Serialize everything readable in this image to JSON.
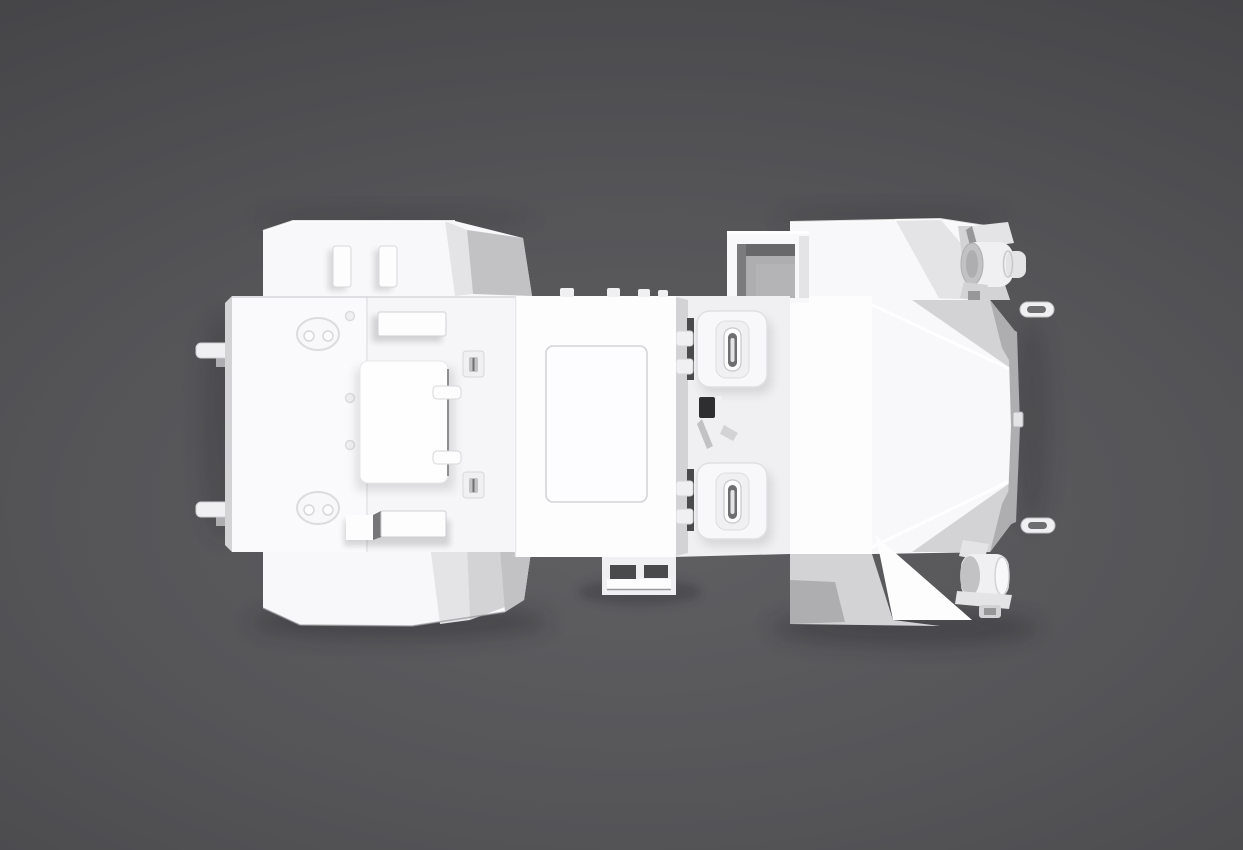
{
  "scene": {
    "type": "3d-render",
    "view": "top-down orthographic",
    "subject": "white armored scout vehicle model on dark gray studio backdrop"
  },
  "palette": {
    "bg_center": "#606063",
    "bg_mid1": "#555558",
    "bg_mid2": "#49494c",
    "bg_edge": "#3b3b3e",
    "c_bright": "#fdfdfe",
    "c_white": "#f8f8fa",
    "c_soft": "#f0f0f2",
    "c_light": "#e4e4e7",
    "c_mid": "#d3d3d6",
    "c_gray": "#c2c2c5",
    "c_dark": "#aeaeb1",
    "c_edge": "#97979a",
    "c_recess": "#6e6e71",
    "c_deep": "#4a4a4d",
    "c_black": "#2e2e30",
    "c_shadow": "#1f1f21"
  },
  "parts": [
    "top-left-fender",
    "fender-light-left",
    "fender-light-right",
    "bottom-left-fender",
    "front-plate",
    "plate-side-edge",
    "lifting-eye-upper",
    "lifting-eye-lower",
    "plate-bolts",
    "stowage-box-top",
    "windshield-hatch",
    "windshield-hinges",
    "latch-block-upper",
    "latch-block-lower",
    "stowage-box-bottom",
    "stowage-cube",
    "tow-hook-upper",
    "tow-hook-lower",
    "cabin-roof",
    "roof-access-panel",
    "roof-edge-tabs",
    "rear-step",
    "crew-deck",
    "crew-hatch-front",
    "crew-hatch-rear",
    "hatch-hinges",
    "hatch-handle-slots",
    "periscope",
    "engine-vent-opening",
    "rear-deck",
    "rear-top-fender",
    "rear-bottom-hull",
    "tail-upper-facet",
    "tail-lower-facet",
    "tail-rear-panel",
    "rear-panel-knob",
    "rear-handle-upper",
    "rear-handle-lower",
    "light-drum-upper",
    "light-drum-lower"
  ]
}
